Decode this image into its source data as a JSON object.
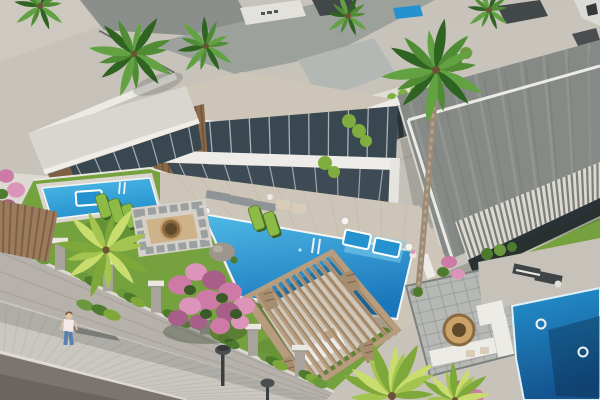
{
  "meta": {
    "title": "Aerial 3D architectural rendering of a modern luxury villa complex",
    "type": "architectural-visualization",
    "view": "aerial-oblique",
    "lighting": "sunny, shadows cast to lower-right"
  },
  "colors": {
    "roof_light": "#c7c3bb",
    "roof_tile": "#cdc6b8",
    "marble": "#8b8f8b",
    "marble_light": "#9da19c",
    "fascia": "#edece8",
    "glass": "#394750",
    "glass_dark": "#2b3237",
    "wood": "#8a684a",
    "wood_dark": "#6e5238",
    "lawn": "#75a13e",
    "lawn_dark": "#5e8a30",
    "pool_light": "#4fb9e6",
    "pool_mid": "#2492cf",
    "pool_deep": "#1a77bb",
    "pool_deepest": "#14548f",
    "deck": "#cdc5b7",
    "deck_gray": "#b6b8b6",
    "path": "#c6c1b8",
    "pergola": "#b79c7d",
    "pergola_dark": "#8f775d",
    "lattice": "#a78d6f",
    "wall": "#b6b2ab",
    "wall_cap": "#eae7e1",
    "pillar": "#a8a49d",
    "sidewalk": "#cac6c0",
    "road": "#7b7470",
    "road_dark": "#6b6561",
    "vine": "#6a983d",
    "vine_dark": "#4e7a2c",
    "palm": "#4f8c34",
    "palm_dark": "#2f6321",
    "palm_mid": "#63a243",
    "palm_bright": "#a3c44f",
    "palm_bright2": "#7fa83a",
    "palm_bright3": "#c9dc6e",
    "pink": "#cd7ba6",
    "pink_light": "#dd94ba",
    "pink_dark": "#a75f8a",
    "topiary": "#7fae3f",
    "lounger_dark": "#3e4447",
    "lounger_gray": "#8f9496",
    "cushion_white": "#edebe6",
    "cushion_beige": "#d9cdb9",
    "tan": "#cba369",
    "firepit_rim": "#8a6a42",
    "firepit_inner": "#5f4a2c",
    "stone": "#9c968c",
    "skin": "#e8c5a2",
    "hair": "#7a5a3e",
    "shirt": "#f3e9e6",
    "jeans": "#5b80af",
    "lamp": "#4a4e50",
    "shadow": "rgba(40,46,42,0.30)",
    "dark_box": "#42474a",
    "white": "#ffffff"
  },
  "scene": {
    "villas": {
      "count_visible": 6,
      "style": "modern flat-roof villas with marble cladding, glass facades, white ribbed fascias and wood-slat accents"
    },
    "pools": [
      {
        "name": "left-villa-pool",
        "features": [
          "in-pool lounger",
          "ladder"
        ]
      },
      {
        "name": "main-villa-pool",
        "features": [
          "two in-pool sunbeds",
          "rock feature",
          "ladder",
          "ball lights",
          "drink table"
        ]
      },
      {
        "name": "right-villa-pool",
        "features": [
          "ring floats",
          "palm shadow on water"
        ]
      }
    ],
    "amenities": [
      "wooden pergola with slatted roof over lounge sofa",
      "sunken lounge with round fire pit",
      "checkered stone patio with L-shaped sofa and round fire bowl",
      "sun loungers on pool decks",
      "green hedge screens",
      "topiary ball shrubs",
      "white louvered canopy terrace",
      "dark slatted entry gate"
    ],
    "vegetation": [
      "tall palm trees",
      "pink bougainvillea trees",
      "manicured lawns",
      "ivy draped on perimeter wall"
    ],
    "street": {
      "elements": [
        "paver sidewalk",
        "asphalt road",
        "perimeter wall with capped pillars",
        "dome street lamps"
      ],
      "pedestrians": 1
    }
  }
}
